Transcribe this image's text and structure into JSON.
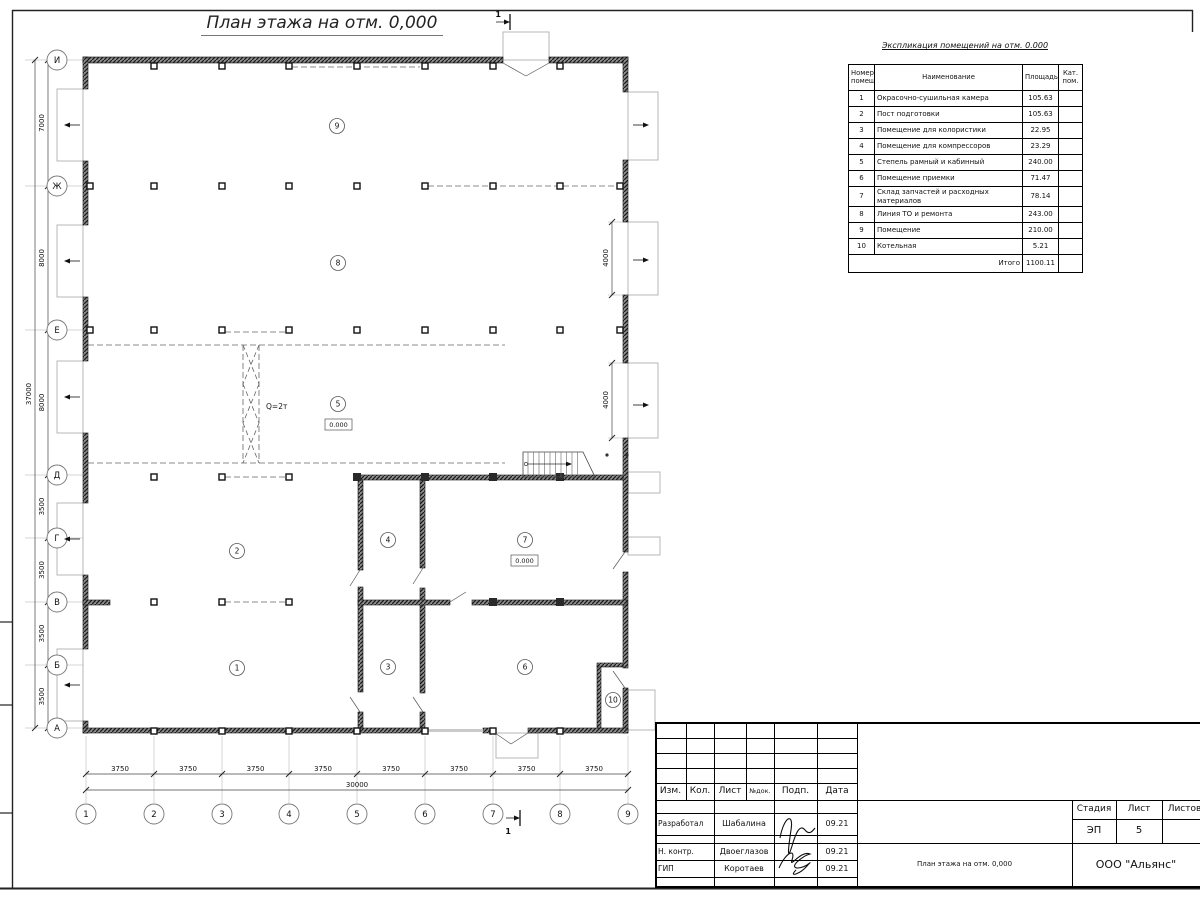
{
  "sheet": {
    "plan_title": "План этажа на отм. 0,000"
  },
  "explication": {
    "title": "Экспликация помещений на отм. 0.000",
    "headers": {
      "number": "Номер помещ.",
      "name": "Наименование",
      "area": "Площадь",
      "category": "Кат. пом."
    },
    "rows": [
      {
        "number": "1",
        "name": "Окрасочно-сушильная камера",
        "area": "105.63",
        "category": ""
      },
      {
        "number": "2",
        "name": "Пост подготовки",
        "area": "105.63",
        "category": ""
      },
      {
        "number": "3",
        "name": "Помещение для колористики",
        "area": "22.95",
        "category": ""
      },
      {
        "number": "4",
        "name": "Помещение для компрессоров",
        "area": "23.29",
        "category": ""
      },
      {
        "number": "5",
        "name": "Степель рамный и кабинный",
        "area": "240.00",
        "category": ""
      },
      {
        "number": "6",
        "name": "Помещение приемки",
        "area": "71.47",
        "category": ""
      },
      {
        "number": "7",
        "name": "Склад запчастей и расходных материалов",
        "area": "78.14",
        "category": ""
      },
      {
        "number": "8",
        "name": "Линия ТО и ремонта",
        "area": "243.00",
        "category": ""
      },
      {
        "number": "9",
        "name": "Помещение",
        "area": "210.00",
        "category": ""
      },
      {
        "number": "10",
        "name": "Котельная",
        "area": "5.21",
        "category": ""
      }
    ],
    "total_label": "Итого",
    "total_area": "1100.11"
  },
  "axes": {
    "vertical": [
      "И",
      "Ж",
      "Е",
      "Д",
      "Г",
      "В",
      "Б",
      "А"
    ],
    "horizontal": [
      "1",
      "2",
      "3",
      "4",
      "5",
      "6",
      "7",
      "8",
      "9"
    ]
  },
  "dimensions": {
    "left_segments": [
      "7000",
      "8000",
      "8000",
      "3500",
      "3500",
      "3500",
      "3500"
    ],
    "left_total": "37000",
    "bottom_segments": [
      "3750",
      "3750",
      "3750",
      "3750",
      "3750",
      "3750",
      "3750",
      "3750"
    ],
    "bottom_total": "30000",
    "right_segments": [
      "4000",
      "4000"
    ]
  },
  "plan": {
    "room_numbers": [
      "1",
      "2",
      "3",
      "4",
      "5",
      "6",
      "7",
      "8",
      "9",
      "10"
    ],
    "crane_label": "Q=2т",
    "level_marks": [
      "0.000",
      "0.000"
    ],
    "section_mark": "1"
  },
  "title_block": {
    "columns": [
      "Изм.",
      "Кол.",
      "Лист",
      "№док.",
      "Подп.",
      "Дата"
    ],
    "rows": [
      {
        "role": "Разработал",
        "name": "Шабалина",
        "date": "09.21"
      },
      {
        "role": "Н. контр.",
        "name": "Двоеглазов",
        "date": "09.21"
      },
      {
        "role": "ГИП",
        "name": "Коротаев",
        "date": "09.21"
      }
    ],
    "stage_label": "Стадия",
    "sheet_label": "Лист",
    "sheets_label": "Листов",
    "stage_value": "ЭП",
    "sheet_value": "5",
    "doc_title": "План этажа на отм. 0,000",
    "company": "ООО \"Альянс\""
  }
}
